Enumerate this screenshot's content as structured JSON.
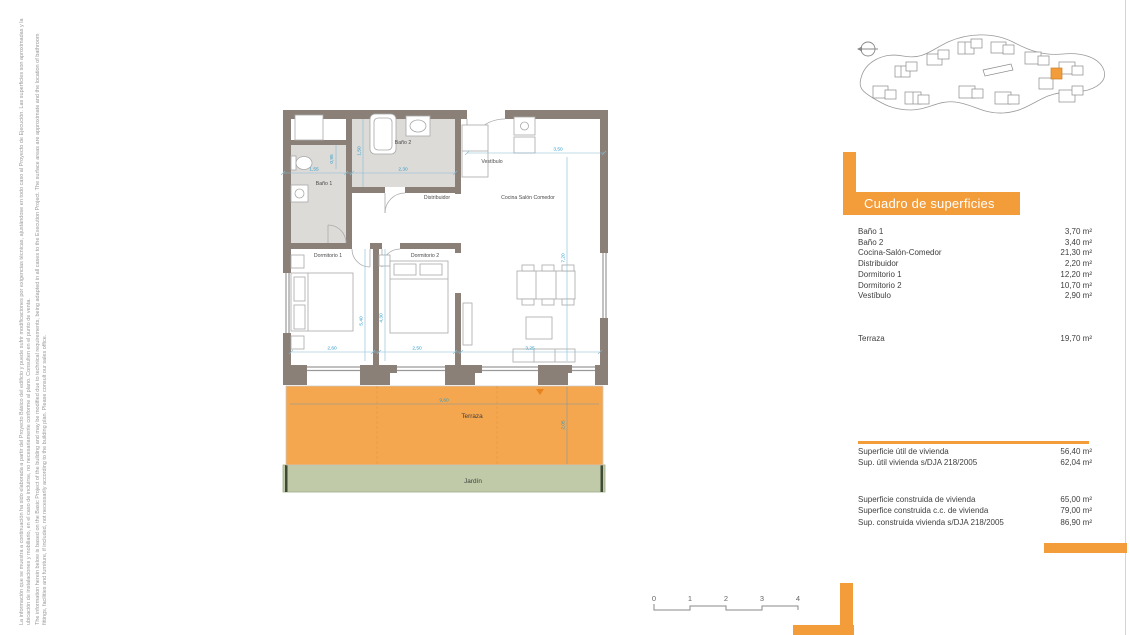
{
  "disclaimer": {
    "es": "La información que se muestra a continuación ha sido elaborada a partir del Proyecto Básico del edificio y puede sufrir modificaciones por exigencias técnicas, ajustándose en todo caso al Proyecto de Ejecución. Las superficies son aproximadas y la ubicación de instalaciones y mobiliario, en el caso de incluirse, no necesariamente conforme al plano. Consulten en el punto de venta.",
    "en": "The information herein below is based on the Basic Project of the building and may be modified due to technical requirements, being adapted in all cases to the Execution Project. The surface areas are approximate and the location of bathroom fittings, facilities and furniture, if included, not necessarily according to the building plan. Please consult our sales office."
  },
  "floor_plan": {
    "labels": [
      "Baño 1",
      "Baño 2",
      "Vestíbulo",
      "Distribuidor",
      "Cocina Salón Comedor",
      "Dormitorio 1",
      "Dormitorio 2",
      "Terraza",
      "Jardín"
    ],
    "dims": [
      "1,55",
      "2,30",
      "0,95",
      "1,50",
      "3,50",
      "7,20",
      "5,40",
      "4,30",
      "2,60",
      "2,50",
      "3,25",
      "9,60",
      "2,05"
    ]
  },
  "surfaces_table": {
    "title": "Cuadro de superficies",
    "rows": [
      {
        "name": "Baño 1",
        "value": "3,70 m²"
      },
      {
        "name": "Baño 2",
        "value": "3,40 m²"
      },
      {
        "name": "Cocina-Salón-Comedor",
        "value": "21,30 m²"
      },
      {
        "name": "Distribuidor",
        "value": "2,20 m²"
      },
      {
        "name": "Dormitorio 1",
        "value": "12,20 m²"
      },
      {
        "name": "Dormitorio 2",
        "value": "10,70 m²"
      },
      {
        "name": "Vestíbulo",
        "value": "2,90 m²"
      }
    ],
    "terraza_row": {
      "name": "Terraza",
      "value": "19,70 m²"
    },
    "useful_rows": [
      {
        "name": "Superficie útil de vivienda",
        "value": "56,40 m²"
      },
      {
        "name": "Sup. útil vivienda s/DJA 218/2005",
        "value": "62,04 m²"
      }
    ],
    "built_rows": [
      {
        "name": "Superficie construida de vivienda",
        "value": "65,00 m²"
      },
      {
        "name": "Superfice construida c.c. de vivienda",
        "value": "79,00 m²"
      },
      {
        "name": "Sup. construida vivienda s/DJA 218/2005",
        "value": "86,90 m²"
      }
    ]
  },
  "scale_bar": {
    "labels": [
      "0",
      "1",
      "2",
      "3",
      "4"
    ]
  },
  "colors": {
    "accent_orange": "#F39C3A",
    "terrace_orange": "#F5A74F",
    "garden_green": "#C0CAA9",
    "wall_gray": "#8B8077",
    "bath_floor": "#DDDBD8",
    "dimension_blue": "#2E9BC8"
  }
}
